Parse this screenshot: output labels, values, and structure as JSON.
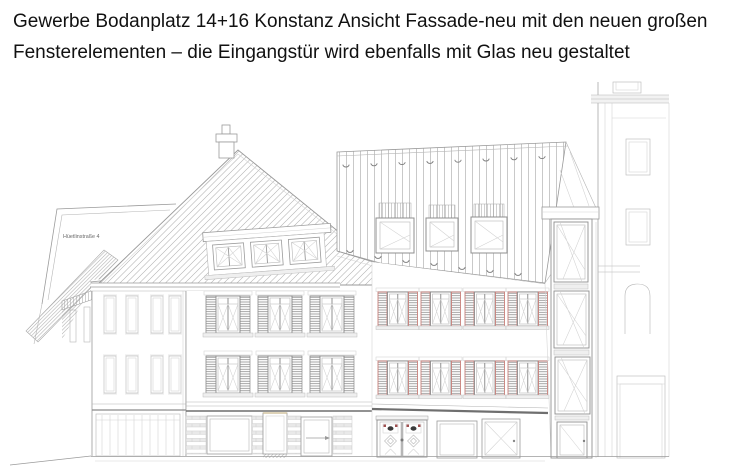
{
  "caption": {
    "line1": "Gewerbe Bodanplatz 14+16 Konstanz Ansicht Fassade-neu mit den neuen großen",
    "line2": "Fensterelementen – die Eingangstür wird ebenfalls mit Glas neu gestaltet"
  },
  "drawing": {
    "type": "facade-elevation-line-drawing",
    "street_label": "Hüetlinstraße 4"
  },
  "colors": {
    "ink": "#9b9b9b",
    "ink-dark": "#6f6f6f",
    "accent-red": "#c9807b",
    "caption-text": "#111111",
    "page-bg": "#ffffff"
  }
}
